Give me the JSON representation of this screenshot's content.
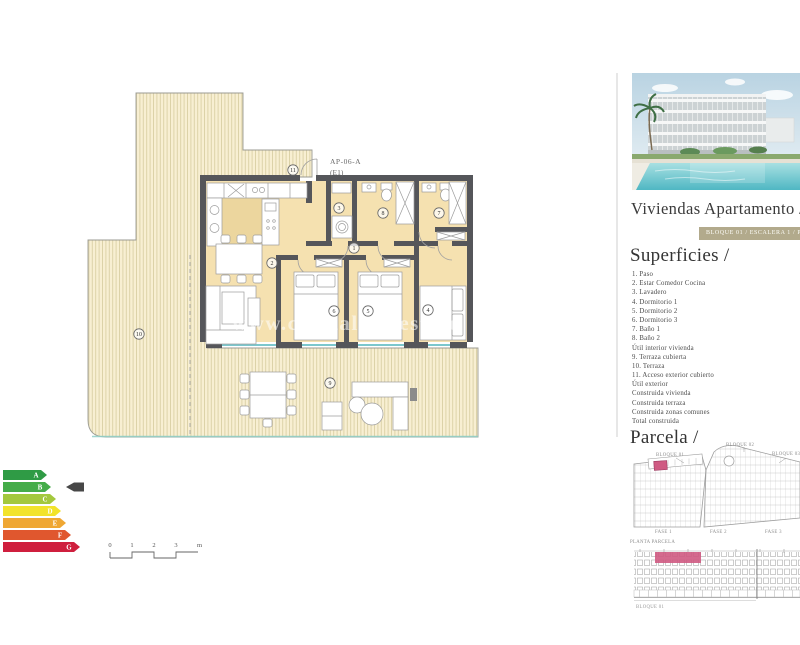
{
  "colors": {
    "badge_bg": "#b2aa8c",
    "highlight_pink": "#cf5a82",
    "floor_beige": "#f5e1b0",
    "window_teal": "#7cc7cd",
    "wall_gray": "#55565a"
  },
  "header": {
    "title": "Viviendas Apartamento /",
    "badge": "BLOQUE 01 / ESCALERA 1 / PLANTA"
  },
  "plan": {
    "unit_label": "AP-06-A",
    "unit_sublabel": "(E1)",
    "watermark": "www.crystalrealestate",
    "numbers": {
      "n1": "1",
      "n2": "2",
      "n3": "3",
      "n4": "4",
      "n5": "5",
      "n6": "6",
      "n7": "7",
      "n8": "8",
      "n9": "9",
      "n10": "10",
      "n11": "11"
    }
  },
  "energy": {
    "letters": [
      "A",
      "B",
      "C",
      "D",
      "E",
      "F",
      "G"
    ],
    "colors": [
      "#2f9b45",
      "#45ac49",
      "#a3c83d",
      "#f2e32b",
      "#efa733",
      "#e0572e",
      "#cf1f3e"
    ],
    "selected": "B"
  },
  "scale": {
    "ticks": [
      "0",
      "1",
      "2",
      "3"
    ],
    "unit": "m"
  },
  "superficies": {
    "heading": "Superficies /",
    "items": [
      "1. Paso",
      "2. Estar Comedor Cocina",
      "3. Lavadero",
      "4. Dormitorio 1",
      "5. Dormitorio 2",
      "6. Dormitorio 3",
      "7. Baño 1",
      "8. Baño 2",
      "Útil interior vivienda",
      "9. Terraza cubierta",
      "10. Terraza",
      "11. Acceso exterior cubierto",
      "Útil exterior",
      "Construida vivienda",
      "Construida terraza",
      "Construida zonas comunes",
      "Total construida"
    ]
  },
  "parcela": {
    "heading": "Parcela /",
    "bloques": [
      "BLOQUE 01",
      "BLOQUE 02",
      "BLOQUE 03"
    ],
    "fases": [
      "FASE 1",
      "FASE 2",
      "FASE 3"
    ],
    "planta_label": "PLANTA PARCELA",
    "elevation_label": "BLOQUE 01"
  }
}
